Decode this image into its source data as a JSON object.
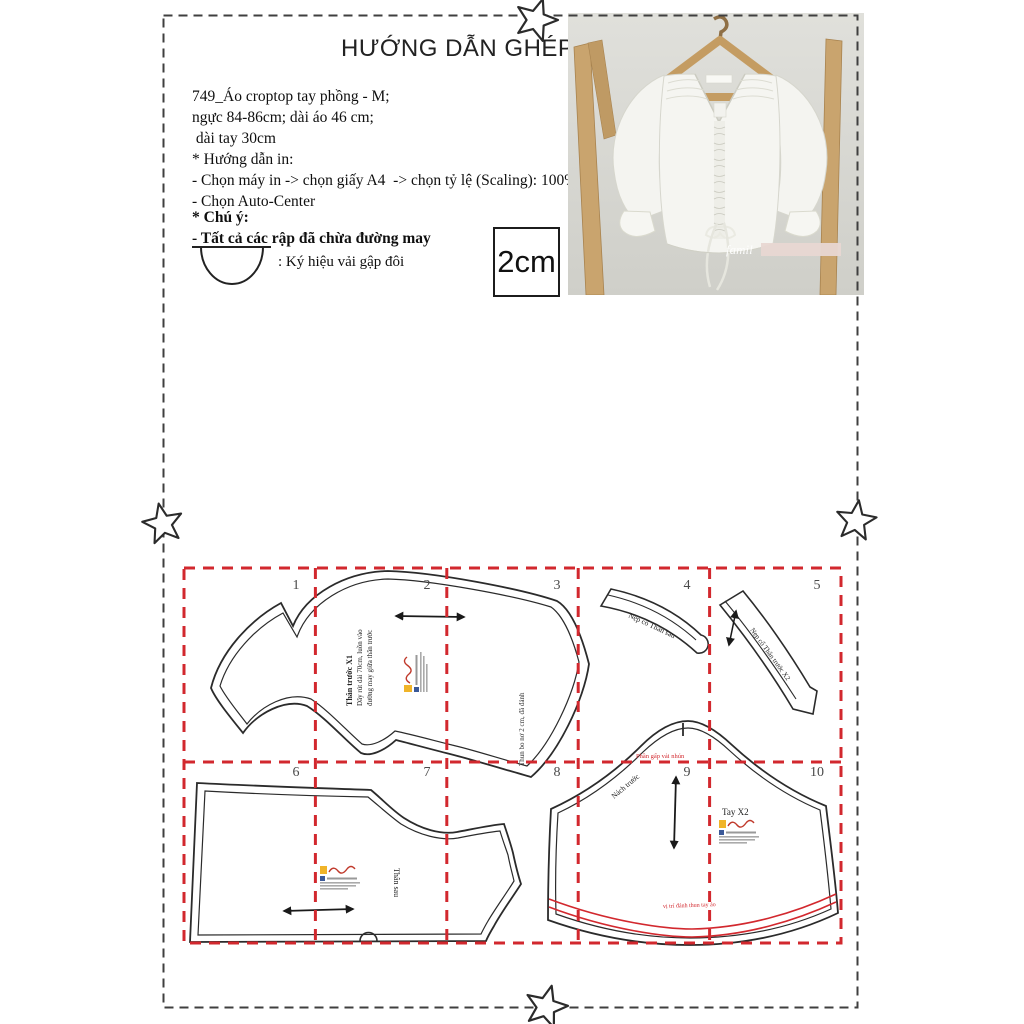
{
  "header": {
    "title": "HƯỚNG DẪN GHÉP RẬP"
  },
  "info": {
    "lines": [
      "749_Áo croptop tay phồng - M;",
      "ngực 84-86cm; dài áo 46 cm;",
      " dài tay 30cm",
      "* Hướng dẫn in:",
      "- Chọn máy in -> chọn giấy A4  -> chọn tỷ lệ (Scaling): 100%",
      "- Chọn Auto-Center"
    ]
  },
  "note": {
    "heading": "* Chú ý:",
    "body": "- Tất cả các rập đã chừa đường may",
    "fold_symbol_label": ": Ký hiệu vải gập đôi"
  },
  "scale_box": {
    "label": "2cm"
  },
  "photo": {
    "watermark": "famil"
  },
  "grid": {
    "line_color": "#d2282e",
    "cells": [
      "1",
      "2",
      "3",
      "4",
      "5",
      "6",
      "7",
      "8",
      "9",
      "10"
    ]
  },
  "pieces": {
    "front_bodice": {
      "label_lines": [
        "Thân trước X1",
        "Dây rút dài 70cm, luồn vào",
        "đường may giữa thân trước"
      ],
      "elastic_note": "Thun bo nơ 2 cm, đã đánh"
    },
    "back_neck_facing": {
      "label": "Nẹp cổ Thân sau"
    },
    "front_neck_facing": {
      "label": "Nẹp cổ Thân trước X2"
    },
    "back_bodice": {
      "label": "Thân sau"
    },
    "sleeve": {
      "label": "Tay X2",
      "cap_note": "Nách trước",
      "gather_note": "Phần gấp vải nhún",
      "hem_note": "vị trí đánh thun tay áo"
    }
  }
}
